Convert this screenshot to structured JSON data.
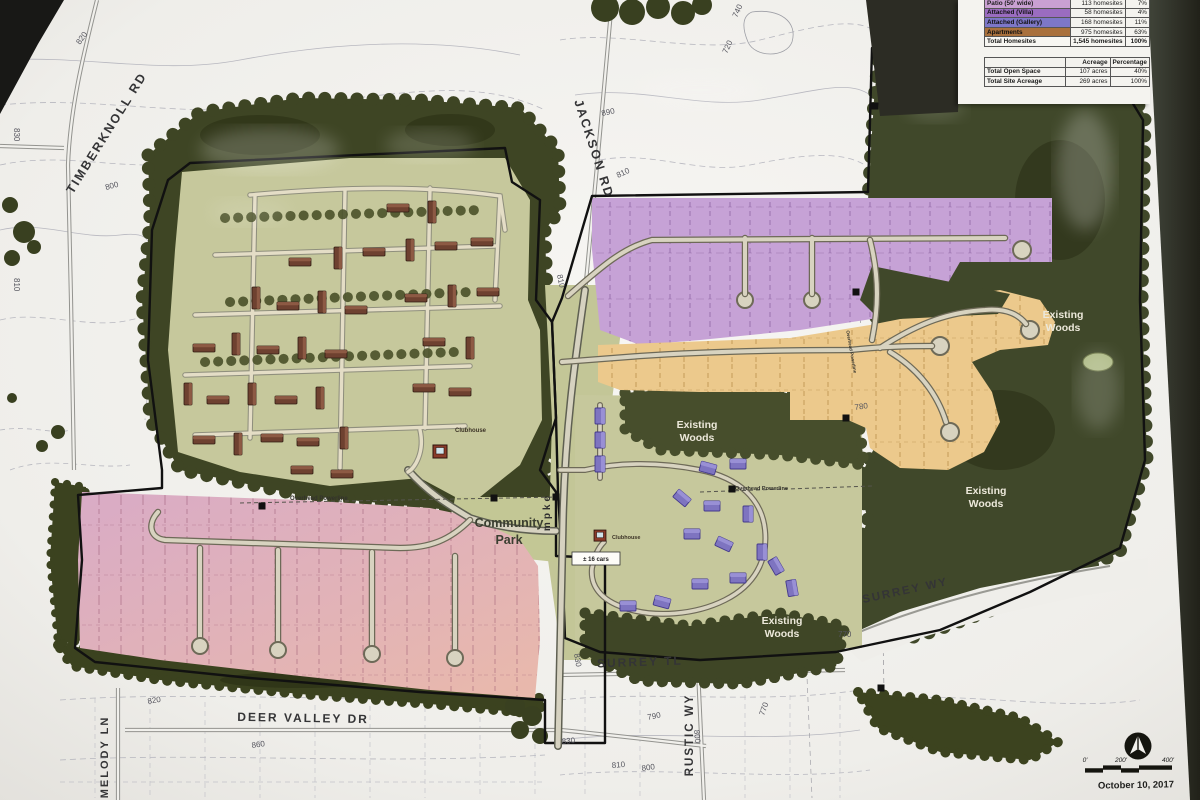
{
  "photo": {
    "date": "October 10, 2017"
  },
  "legend": {
    "housing": {
      "rows": [
        {
          "label": "Patio (50' wide)",
          "count": "113 homesites",
          "pct": "7%"
        },
        {
          "label": "Attached (Villa)",
          "count": "58 homesites",
          "pct": "4%"
        },
        {
          "label": "Attached (Gallery)",
          "count": "168 homesites",
          "pct": "11%"
        },
        {
          "label": "Apartments",
          "count": "975 homesites",
          "pct": "63%"
        },
        {
          "label": "Total Homesites",
          "count": "1,545 homesites",
          "pct": "100%"
        }
      ]
    },
    "acreage": {
      "headers": {
        "col2": "Acreage",
        "col3": "Percentage"
      },
      "rows": [
        {
          "label": "Total Open Space",
          "value": "107 acres",
          "pct": "40%"
        },
        {
          "label": "Total Site Acreage",
          "value": "269 acres",
          "pct": "100%"
        }
      ]
    }
  },
  "map": {
    "roads": {
      "timberknoll": "TIMBERKNOLL RD",
      "jackson": "JACKSON RD",
      "surrey_wy": "SURREY WY",
      "surrey_tl": "SURREY TL",
      "rustic_wy": "RUSTIC WY",
      "deer_valley": "DEER VALLEY DR",
      "melody": "MELODY LN",
      "tnpke_partial": "mpke"
    },
    "labels": {
      "community_l1": "Community",
      "community_l2": "Park",
      "existing_l1": "Existing",
      "existing_l2": "Woods",
      "clubhouse": "Clubhouse",
      "parking": "± 16 cars",
      "powerline": "Overhead  Powerline"
    },
    "contours": {
      "c720": "720",
      "c740": "740",
      "c770": "770",
      "c780": "780",
      "c790": "790",
      "c800": "800",
      "c810": "810",
      "c820": "820",
      "c830": "830",
      "c860": "860",
      "c890": "890"
    },
    "scale": {
      "s0": "0'",
      "s200": "200'",
      "s400": "400'"
    }
  },
  "colors": {
    "patio_area_pink": "#dcaec7",
    "gallery_buildings_purple": "#7e74c0",
    "purple_lots": "#c6a2d6",
    "orange_lots": "#ecc98c",
    "apartments_brown": "#6e4130",
    "open_space_olive": "#c6c89c",
    "woods_dark_green": "#3f4626",
    "swatch_patio": "#c9a0d2",
    "swatch_villa": "#9a6cc0",
    "swatch_gallery": "#7d77c8",
    "swatch_apartments": "#a9703c"
  }
}
